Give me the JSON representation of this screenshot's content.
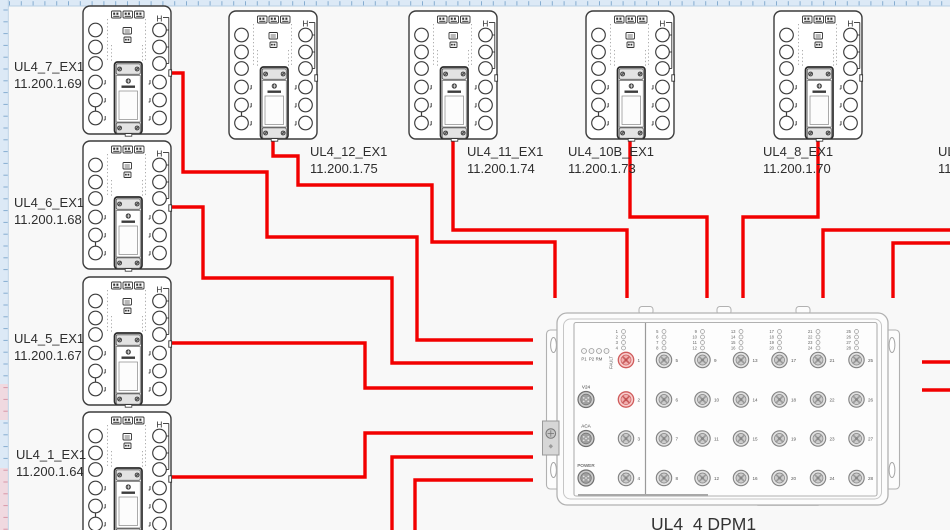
{
  "canvas": {
    "bg": "#f8f8f8",
    "ruler_bg": "#dce9f6",
    "ruler_tick": "#86add1",
    "ruler_tick_pink": "#d897a8",
    "ruler_pink_fill": "#f0d9e0",
    "ruler_edge": "#b9cfe4",
    "wire_color": "#f20000",
    "device_outline": "#3b3b3b",
    "dpm_outline": "#b1b1b1",
    "port_red_ring": "#d05c5c",
    "port_red_fill": "#f7cdcd"
  },
  "diagram": {
    "ex1_h_label": "H",
    "devices": [
      {
        "id": "UL4_7_EX1",
        "ip": "11.200.1.69",
        "x": 82,
        "y": 5,
        "label_x": 14,
        "label_y": 58
      },
      {
        "id": "UL4_6_EX1",
        "ip": "11.200.1.68",
        "x": 82,
        "y": 140,
        "label_x": 14,
        "label_y": 194
      },
      {
        "id": "UL4_5_EX1",
        "ip": "11.200.1.67",
        "x": 82,
        "y": 276,
        "label_x": 14,
        "label_y": 330
      },
      {
        "id": "UL4_1_EX1",
        "ip": "11.200.1.64",
        "x": 82,
        "y": 411,
        "label_x": 16,
        "label_y": 446
      },
      {
        "id": "UL4_12_EX1",
        "ip": "11.200.1.75",
        "x": 228,
        "y": 10,
        "label_x": 310,
        "label_y": 143
      },
      {
        "id": "UL4_11_EX1",
        "ip": "11.200.1.74",
        "x": 408,
        "y": 10,
        "label_x": 467,
        "label_y": 143
      },
      {
        "id": "UL4_10B_EX1",
        "ip": "11.200.1.73",
        "x": 585,
        "y": 10,
        "label_x": 568,
        "label_y": 143
      },
      {
        "id": "UL4_8_EX1",
        "ip": "11.200.1.70",
        "x": 773,
        "y": 10,
        "label_x": 763,
        "label_y": 143
      }
    ],
    "partial_label": {
      "label": "UL4",
      "ip": "11.2",
      "x": 938,
      "y": 143
    },
    "wires": [
      {
        "id": "ul4_7",
        "points": [
          [
            172,
            73
          ],
          [
            183,
            73
          ],
          [
            183,
            172
          ],
          [
            267,
            172
          ],
          [
            267,
            237
          ],
          [
            417,
            237
          ],
          [
            417,
            340
          ],
          [
            533,
            340
          ]
        ]
      },
      {
        "id": "ul4_6",
        "points": [
          [
            172,
            207
          ],
          [
            203,
            207
          ],
          [
            203,
            278
          ],
          [
            392,
            278
          ],
          [
            392,
            363
          ],
          [
            533,
            363
          ]
        ]
      },
      {
        "id": "ul4_5",
        "points": [
          [
            172,
            343
          ],
          [
            365,
            343
          ],
          [
            365,
            388
          ],
          [
            533,
            388
          ]
        ]
      },
      {
        "id": "ul4_1",
        "points": [
          [
            172,
            477
          ],
          [
            365,
            477
          ],
          [
            365,
            433
          ],
          [
            533,
            433
          ]
        ]
      },
      {
        "id": "ul4_12",
        "points": [
          [
            273,
            134
          ],
          [
            273,
            156
          ],
          [
            298,
            156
          ],
          [
            298,
            185
          ],
          [
            432,
            185
          ],
          [
            432,
            242
          ],
          [
            555,
            242
          ],
          [
            555,
            298
          ]
        ]
      },
      {
        "id": "ul4_11",
        "points": [
          [
            453,
            134
          ],
          [
            453,
            230
          ],
          [
            627,
            230
          ],
          [
            627,
            298
          ]
        ]
      },
      {
        "id": "ul4_10b",
        "points": [
          [
            630,
            134
          ],
          [
            630,
            217
          ],
          [
            707,
            217
          ],
          [
            707,
            298
          ]
        ]
      },
      {
        "id": "ul4_8",
        "points": [
          [
            818,
            134
          ],
          [
            818,
            217
          ],
          [
            743,
            217
          ],
          [
            743,
            298
          ]
        ]
      },
      {
        "id": "offscreen_right_1",
        "points": [
          [
            951,
            230
          ],
          [
            823,
            230
          ],
          [
            823,
            298
          ]
        ]
      },
      {
        "id": "offscreen_right_2",
        "points": [
          [
            951,
            243
          ],
          [
            893,
            243
          ],
          [
            893,
            298
          ]
        ]
      },
      {
        "id": "offscreen_bottom_1",
        "points": [
          [
            533,
            457
          ],
          [
            392,
            457
          ],
          [
            392,
            531
          ]
        ]
      },
      {
        "id": "offscreen_bottom_2",
        "points": [
          [
            533,
            480
          ],
          [
            415,
            480
          ],
          [
            415,
            531
          ]
        ]
      },
      {
        "id": "right_stub_1",
        "points": [
          [
            922,
            362
          ],
          [
            951,
            362
          ]
        ]
      },
      {
        "id": "right_stub_2",
        "points": [
          [
            922,
            390
          ],
          [
            951,
            390
          ]
        ]
      }
    ],
    "ruler": {
      "pink_ranges": [
        [
          384,
          420
        ],
        [
          468,
          530
        ]
      ]
    },
    "dpm": {
      "label": "UL4_4 DPM1",
      "status_leds": [
        "P1",
        "P2",
        "RM",
        "FAULT"
      ],
      "power": [
        "V24",
        "ACA",
        "POWER"
      ],
      "ports_left": [
        1,
        2,
        3,
        4
      ],
      "red_ports": [
        1,
        2
      ],
      "led_left": [
        1,
        2,
        3,
        4
      ],
      "port_columns": [
        [
          5,
          6,
          7,
          8
        ],
        [
          9,
          10,
          11,
          12
        ],
        [
          13,
          14,
          15,
          16
        ],
        [
          17,
          18,
          19,
          20
        ],
        [
          21,
          22,
          23,
          24
        ],
        [
          25,
          26,
          27,
          28
        ]
      ]
    }
  }
}
